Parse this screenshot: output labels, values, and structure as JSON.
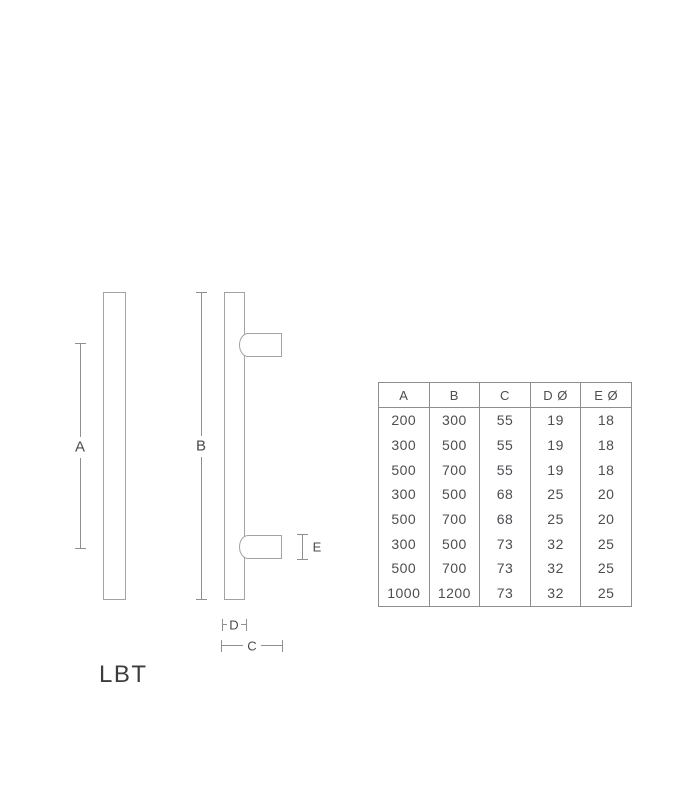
{
  "product": {
    "model_label": "LBT"
  },
  "diagram": {
    "dim_labels": {
      "a": "A",
      "b": "B",
      "c": "C",
      "d": "D",
      "e": "E"
    }
  },
  "spec_table": {
    "headers": [
      "A",
      "B",
      "C",
      "D Ø",
      "E Ø"
    ],
    "rows": [
      [
        "200",
        "300",
        "55",
        "19",
        "18"
      ],
      [
        "300",
        "500",
        "55",
        "19",
        "18"
      ],
      [
        "500",
        "700",
        "55",
        "19",
        "18"
      ],
      [
        "300",
        "500",
        "68",
        "25",
        "20"
      ],
      [
        "500",
        "700",
        "68",
        "25",
        "20"
      ],
      [
        "300",
        "500",
        "73",
        "32",
        "25"
      ],
      [
        "500",
        "700",
        "73",
        "32",
        "25"
      ],
      [
        "1000",
        "1200",
        "73",
        "32",
        "25"
      ]
    ]
  },
  "colors": {
    "outline": "#a3a3a3",
    "dimension_line": "#8f8f8f",
    "label_text": "#4a4a4a",
    "model_text": "#3d3d3d",
    "table_border": "#8d8d8d",
    "table_text": "#4b4e52"
  }
}
